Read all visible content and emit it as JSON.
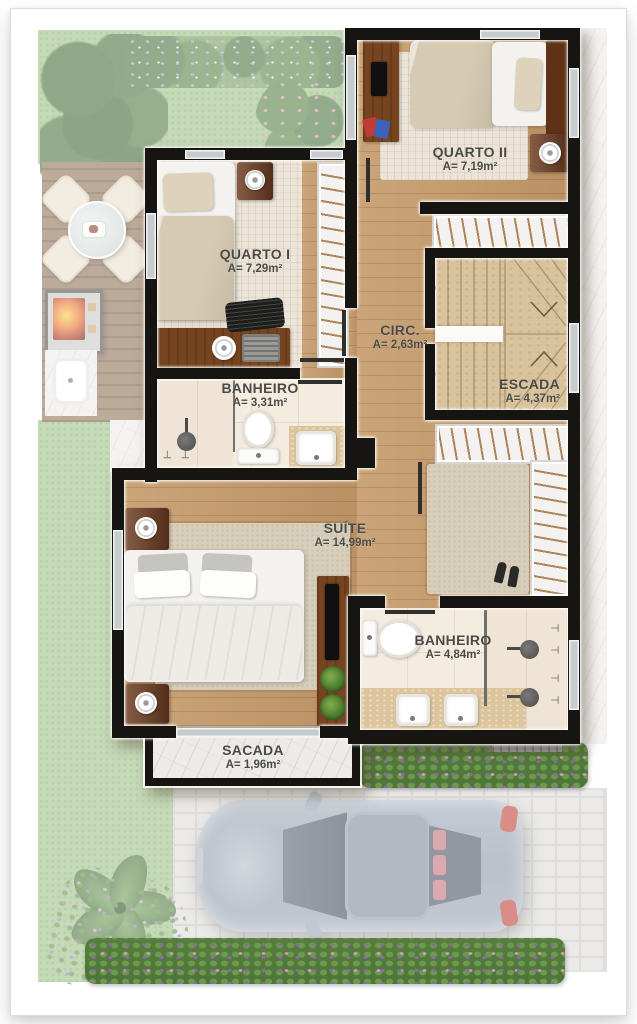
{
  "plan": {
    "rooms": [
      {
        "id": "quarto-ii",
        "name": "QUARTO II",
        "area": "A= 7,19m²"
      },
      {
        "id": "quarto-i",
        "name": "QUARTO I",
        "area": "A= 7,29m²"
      },
      {
        "id": "circulacao",
        "name": "CIRC.",
        "area": "A= 2,63m²"
      },
      {
        "id": "escada",
        "name": "ESCADA",
        "area": "A= 4,37m²"
      },
      {
        "id": "banheiro-social",
        "name": "BANHEIRO",
        "area": "A= 3,31m²"
      },
      {
        "id": "suite",
        "name": "SUÍTE",
        "area": "A= 14,99m²"
      },
      {
        "id": "banheiro-suite",
        "name": "BANHEIRO",
        "area": "A= 4,84m²"
      },
      {
        "id": "sacada",
        "name": "SACADA",
        "area": "A= 1,96m²"
      }
    ]
  },
  "palette": {
    "wall": "#171512",
    "wood_floor": "#c59a6a",
    "parquet": "#ece4d8",
    "bath_tile": "#f4ecdf",
    "stair": "#d9c39d",
    "marble": "#ecebe8",
    "grass": "#9cc084",
    "deck_wood": "#8d6e52",
    "label_text": "#4a4a45",
    "car_body": "#909cac",
    "fire": "#e8692a"
  }
}
